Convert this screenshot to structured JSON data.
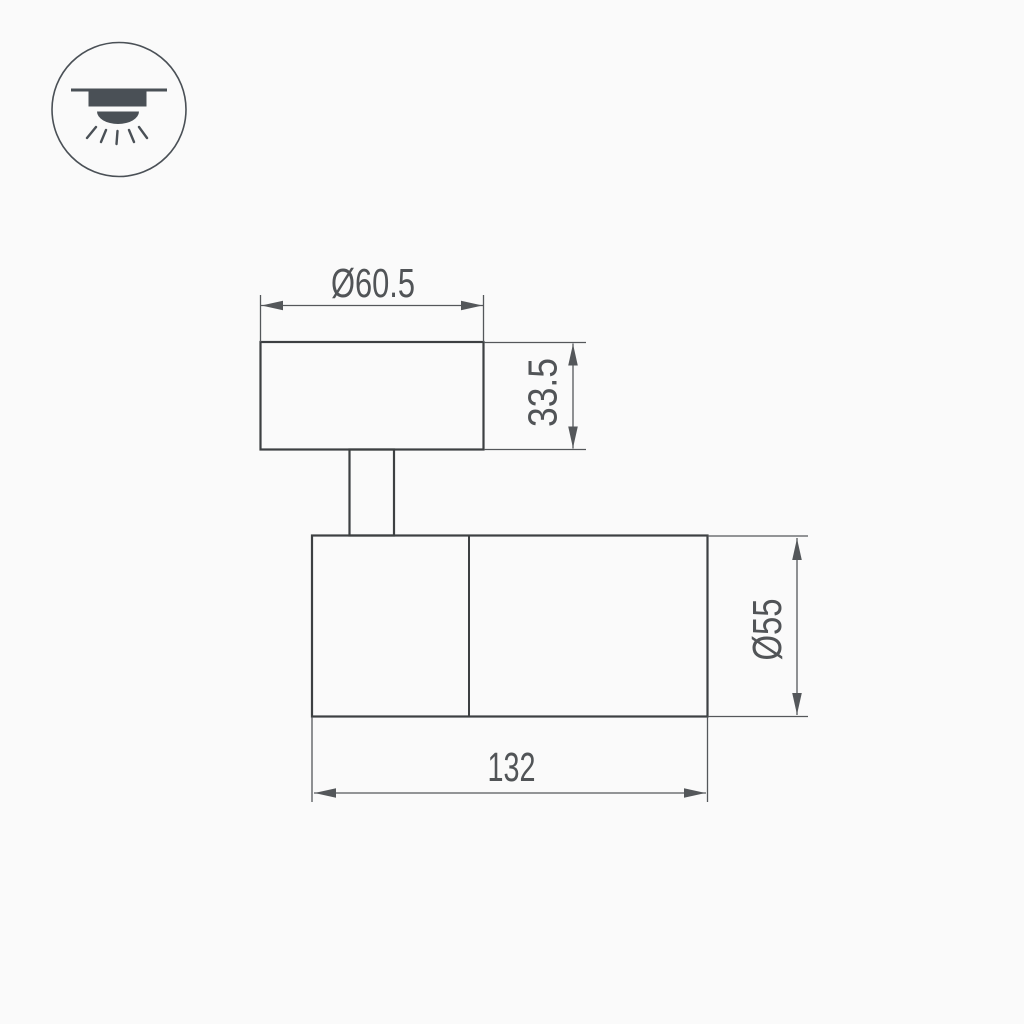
{
  "colors": {
    "background": "#fafafa",
    "object_line": "#3d4042",
    "dimension_line": "#54575a",
    "text": "#515457",
    "icon": "#4a5056"
  },
  "icon": {
    "name": "ceiling-light-icon"
  },
  "drawing": {
    "dimensions": {
      "base_diameter": "Ø60.5",
      "base_height": "33.5",
      "body_diameter": "Ø55",
      "body_length": "132"
    }
  }
}
